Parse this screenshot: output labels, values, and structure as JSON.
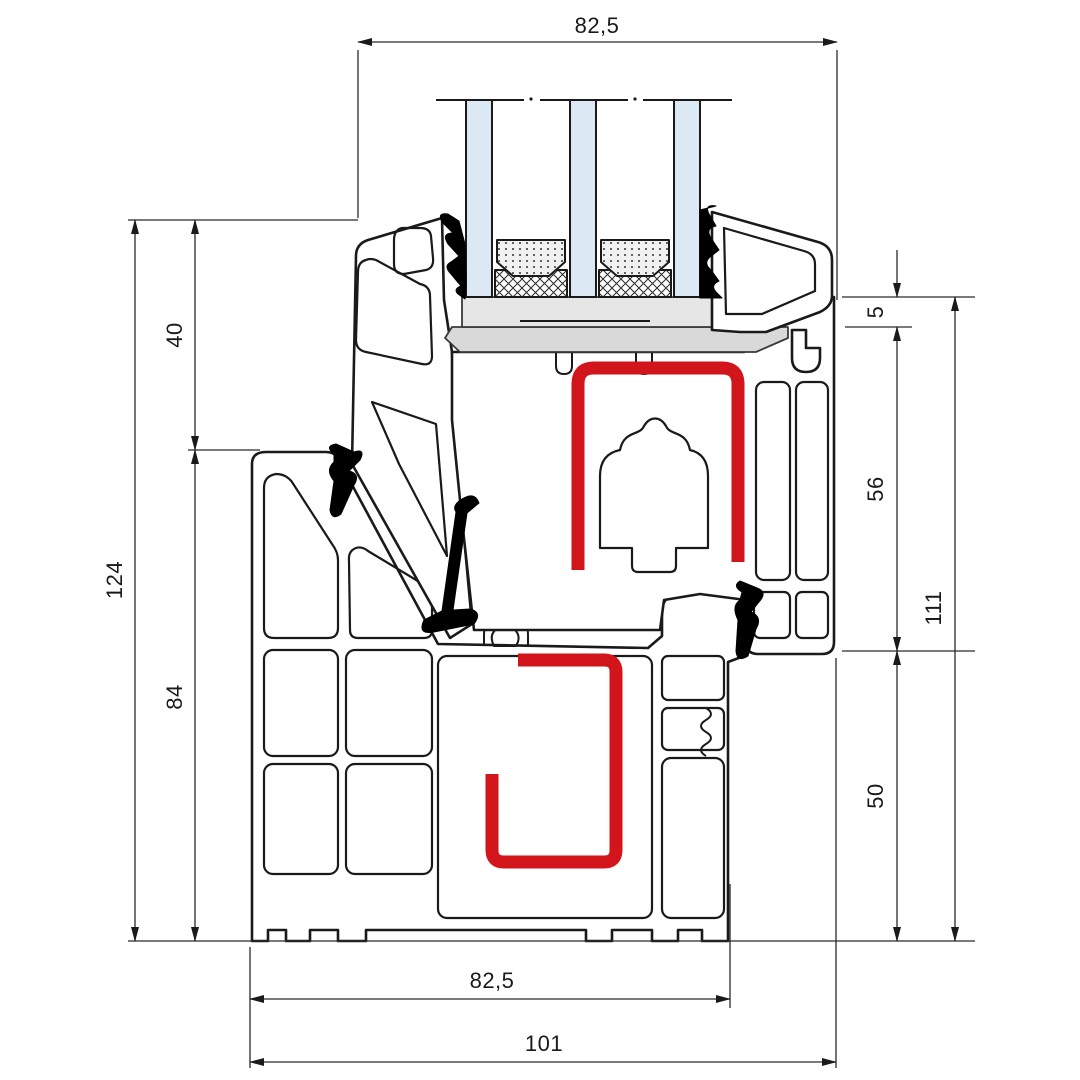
{
  "drawing": {
    "type": "technical-cross-section",
    "subject": "PVC window frame and sash profile section with triple glazing",
    "dimensions": [
      {
        "id": "sash-width-top",
        "label": "82,5",
        "orientation": "horizontal",
        "position": "top"
      },
      {
        "id": "sash-face-height",
        "label": "40",
        "orientation": "vertical",
        "position": "left"
      },
      {
        "id": "total-height",
        "label": "124",
        "orientation": "vertical",
        "position": "left"
      },
      {
        "id": "frame-face-height",
        "label": "84",
        "orientation": "vertical",
        "position": "left"
      },
      {
        "id": "glazing-packer",
        "label": "5",
        "orientation": "vertical",
        "position": "right"
      },
      {
        "id": "sash-height",
        "label": "56",
        "orientation": "vertical",
        "position": "right"
      },
      {
        "id": "sash-frame-height",
        "label": "111",
        "orientation": "vertical",
        "position": "right"
      },
      {
        "id": "frame-height",
        "label": "50",
        "orientation": "vertical",
        "position": "right"
      },
      {
        "id": "frame-width-bottom",
        "label": "82,5",
        "orientation": "horizontal",
        "position": "bottom"
      },
      {
        "id": "total-width-bottom",
        "label": "101",
        "orientation": "horizontal",
        "position": "bottom"
      }
    ],
    "colors": {
      "reinforcement_red": "#d2151b",
      "glass_blue": "#dce9f5",
      "packer_grey_light": "#e6e6e6",
      "packer_grey_dark": "#d9d9d9",
      "line_black": "#1a1a1a",
      "background": "#ffffff"
    },
    "components": [
      "triple-glazing",
      "glass-spacer",
      "edge-sealant",
      "glazing-packers",
      "sash-profile",
      "glazing-bead",
      "frame-profile",
      "steel-reinforcement-sash",
      "steel-reinforcement-frame",
      "center-gasket",
      "frame-outer-gasket",
      "frame-rebate-gasket",
      "glazing-gaskets"
    ]
  }
}
